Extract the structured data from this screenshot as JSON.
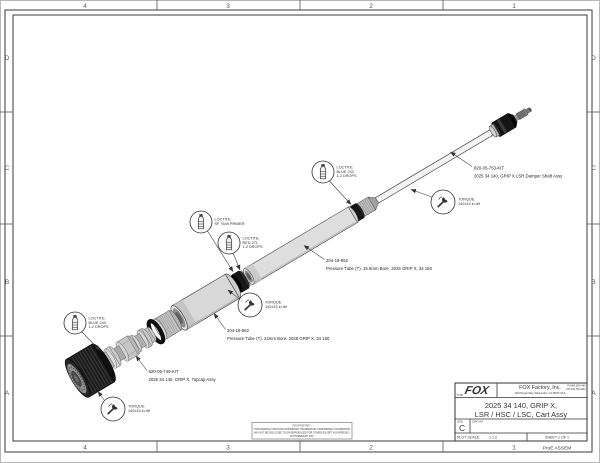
{
  "sheet": {
    "zones_top": [
      "4",
      "3",
      "2",
      "1"
    ],
    "zones_bottom": [
      "4",
      "3",
      "2",
      "1"
    ],
    "zones_left": [
      "D",
      "C",
      "B",
      "A"
    ],
    "zones_right": [
      "D",
      "C",
      "B",
      "A"
    ],
    "footer_right": "ProE ASSEM"
  },
  "title_block": {
    "logo_text": "FOX",
    "company": "FOX Factory, Inc.",
    "address": "130 Hangar Way, Watsonville, CA 95076 USA",
    "phone": "PH 800-369-7469",
    "fax": "FAX 831-768-9342",
    "type_label": "TYPE",
    "title_line1": "2025 34 140, GRIP X,",
    "title_line2": "LSR / HSC / LSC, Cart Assy",
    "size_label": "SIZE",
    "size_value": "C",
    "dwg_label": "DWG NO",
    "scale_label": "PLOT SCALE",
    "scale_value": "1:1.2",
    "sheet_info": "SHEET 1 OF 1"
  },
  "proprietary": {
    "line1": "PROPRIETARY:",
    "line2": "THIS DRAWING CONTAINS PROPRIETARY INFORMATION. PROPRIETARY INFORMATION",
    "line3": "MAY NOT BE DISCLOSED TO OR REPRODUCED FOR OTHERS EXCEPT AS EXPRESSLY",
    "line4": "AUTHORIZED BY FOX."
  },
  "part_labels": [
    {
      "pn": "820-05-753-KIT",
      "desc": "2025 34 140, GRIP X LSR Damper Shaft Assy"
    },
    {
      "pn": "204-18-952",
      "desc": "Pressure Tube (T), 15.5mm Bore, 2025 GRIP X, 34 150"
    },
    {
      "pn": "204-18-962",
      "desc": "Pressure Tube (T), 24mm Bore, 2025 GRIP X, 34 150"
    },
    {
      "pn": "820-05-749-KIT",
      "desc": "2025 34 140, GRIP X, Topcap Assy"
    }
  ],
  "process_callouts": {
    "torque_shaft": {
      "l1": "TORQUE:",
      "l2": "140±15 in-lbf"
    },
    "torque_tube": {
      "l1": "TORQUE:",
      "l2": "140±15 in-lbf"
    },
    "torque_topcap": {
      "l1": "TORQUE:",
      "l2": "140±15 in-lbf"
    },
    "loctite_blue_shaft": {
      "l1": "LOCTITE:",
      "l2": "BLUE 243",
      "l3": "1-2 DROPS"
    },
    "loctite_primer": {
      "l1": "LOCTITE:",
      "l2": "SF 7649 PRIMER"
    },
    "loctite_red": {
      "l1": "LOCTITE:",
      "l2": "RED 271",
      "l3": "1-2 DROPS"
    },
    "loctite_blue_topcap": {
      "l1": "LOCTITE:",
      "l2": "BLUE 243",
      "l3": "1-2 DROPS"
    }
  },
  "colors": {
    "paper": "#ffffff",
    "line": "#3a3a3a",
    "part_dark": "#141414"
  }
}
